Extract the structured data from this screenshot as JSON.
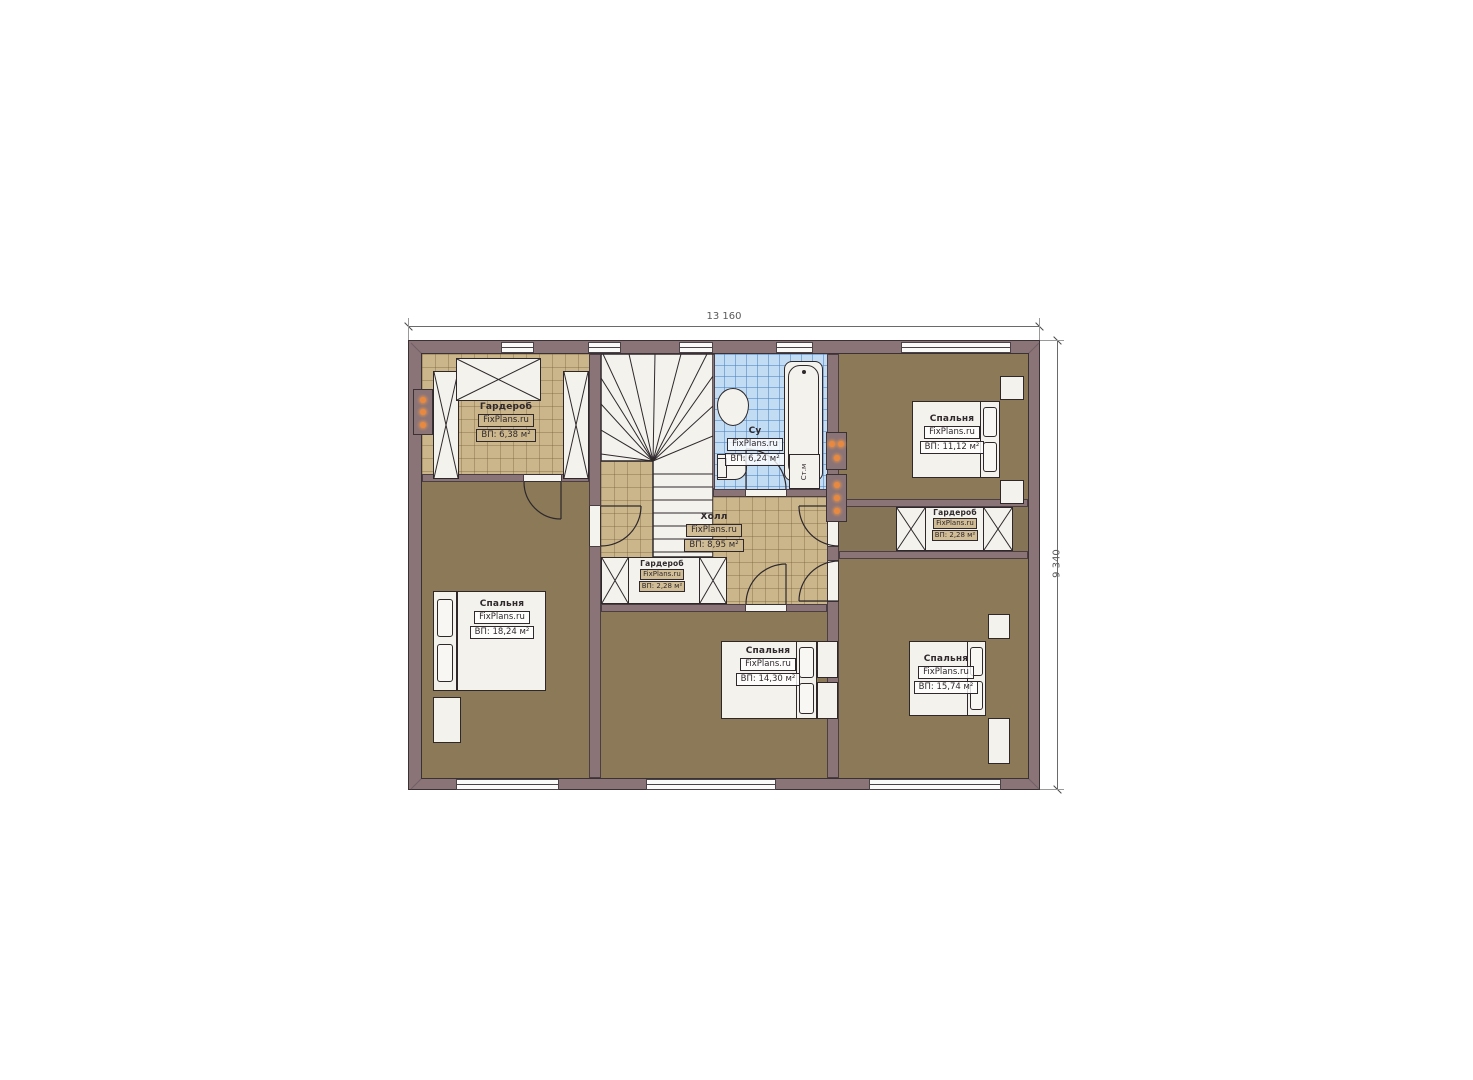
{
  "watermark": "FixPlans.ru",
  "dimensions": {
    "width_label": "13 160",
    "height_label": "9 340"
  },
  "rooms": [
    {
      "name": "Гардероб",
      "area": "ВП: 6,38 м²"
    },
    {
      "name": "Су",
      "area": "ВП: 6,24 м²"
    },
    {
      "name": "Спальня",
      "area": "ВП: 11,12 м²"
    },
    {
      "name": "Холл",
      "area": "ВП: 8,95 м²"
    },
    {
      "name": "Гардероб",
      "area": "ВП: 2,28 м²"
    },
    {
      "name": "Гардероб",
      "area": "ВП: 2,28 м²"
    },
    {
      "name": "Спальня",
      "area": "ВП: 18,24 м²"
    },
    {
      "name": "Спальня",
      "area": "ВП: 14,30 м²"
    },
    {
      "name": "Спальня",
      "area": "ВП: 15,74 м²"
    }
  ],
  "appliances": {
    "washing_machine": "Ст.м"
  },
  "colors": {
    "exterior_wall": "#8a7478",
    "wood_floor": "#8b7958",
    "tile_floor": "#cbb68c",
    "bath_floor": "#c2dcf4",
    "furniture": "#f3f2ec",
    "outline": "#2e282b",
    "accent_dots": "#e8893f"
  }
}
